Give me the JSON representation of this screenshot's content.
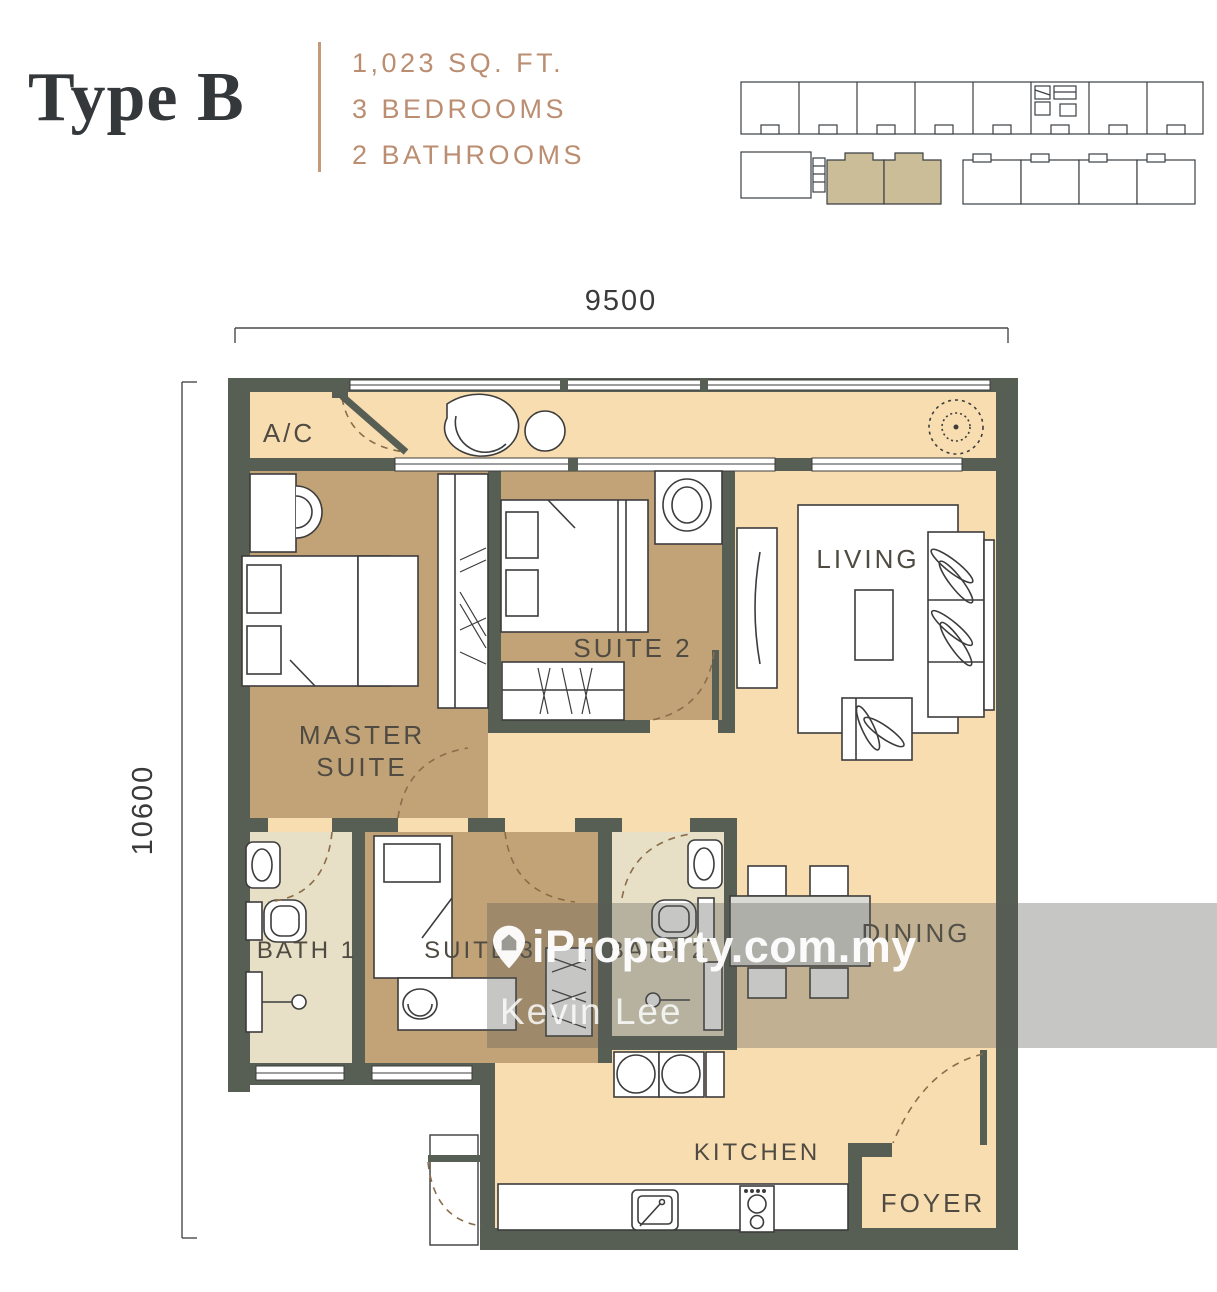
{
  "header": {
    "title": "Type B",
    "spec_area": "1,023 SQ. FT.",
    "spec_bedrooms": "3 BEDROOMS",
    "spec_bathrooms": "2 BATHROOMS"
  },
  "dimensions": {
    "width_mm": "9500",
    "height_mm": "10600"
  },
  "rooms": {
    "ac": "A/C",
    "master_1": "MASTER",
    "master_2": "SUITE",
    "suite2": "SUITE 2",
    "living": "LIVING",
    "bath1": "BATH 1",
    "suite3": "SUITE 3",
    "bath2": "BATH 2",
    "dining": "DINING",
    "kitchen": "KITCHEN",
    "foyer": "FOYER"
  },
  "watermark": {
    "brand": "iProperty.com.my",
    "agent": "Kevin Lee"
  },
  "colors": {
    "accent": "#bb8e72",
    "title": "#34383a",
    "wall": "#575e54",
    "floor_light": "#f8ddb1",
    "floor_tan": "#c2a377",
    "floor_bath": "#e7dfc6",
    "keyplan_highlight": "#cabd97",
    "label": "#4f4b42"
  }
}
